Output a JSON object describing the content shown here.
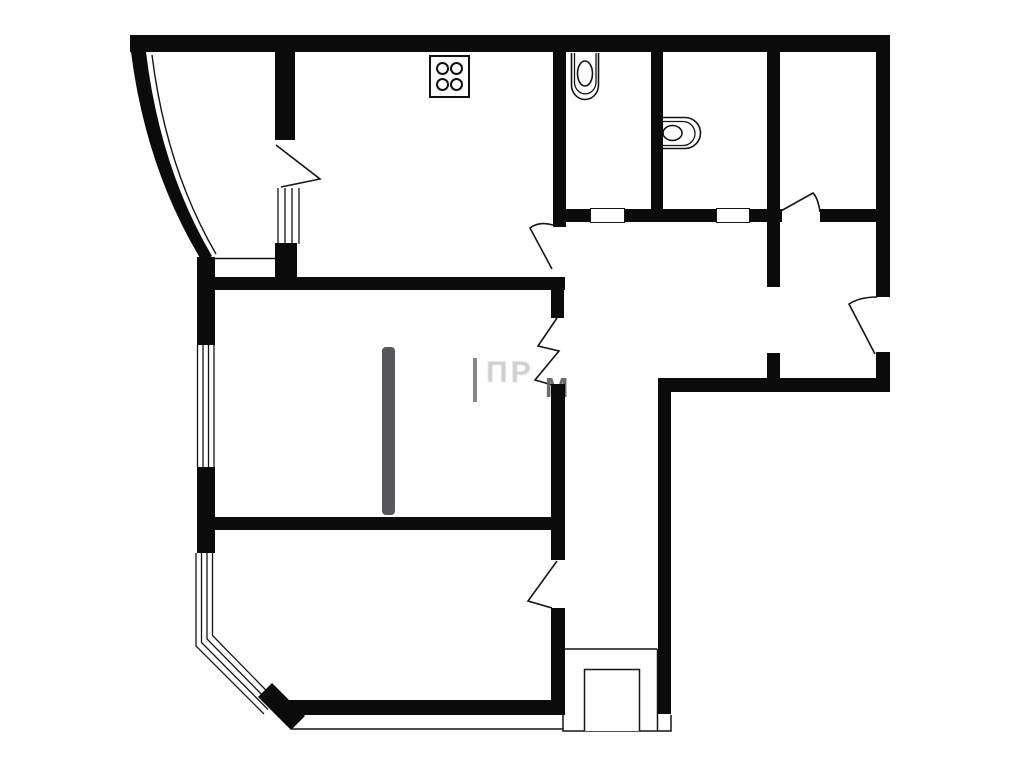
{
  "document": {
    "type": "apartment-floor-plan",
    "background": "#ffffff",
    "ink": "#0b0b0b"
  },
  "watermark": {
    "fragment_1": "ПР",
    "fragment_2": "М"
  },
  "plan": {
    "canvas": {
      "width": 1023,
      "height": 768
    },
    "walls": [
      {
        "name": "wall-top",
        "x": 130,
        "y": 35,
        "w": 760,
        "h": 17
      },
      {
        "name": "wall-right-upper",
        "x": 876,
        "y": 35,
        "w": 14,
        "h": 262
      },
      {
        "name": "wall-right-stub",
        "x": 876,
        "y": 352,
        "w": 14,
        "h": 40
      },
      {
        "name": "wall-closet-left",
        "x": 767,
        "y": 52,
        "w": 13,
        "h": 235
      },
      {
        "name": "wall-closet-left-stub",
        "x": 767,
        "y": 353,
        "w": 13,
        "h": 29
      },
      {
        "name": "wall-wc-bath-divider",
        "x": 651,
        "y": 52,
        "w": 12,
        "h": 161
      },
      {
        "name": "wall-wc-left",
        "x": 553,
        "y": 52,
        "w": 13,
        "h": 175
      },
      {
        "name": "wall-hall-south",
        "x": 658,
        "y": 378,
        "w": 232,
        "h": 14
      },
      {
        "name": "wall-right-lower",
        "x": 658,
        "y": 378,
        "w": 13,
        "h": 336
      },
      {
        "name": "wall-sanitary-south-a",
        "x": 566,
        "y": 209,
        "w": 24,
        "h": 13
      },
      {
        "name": "wall-sanitary-south-b",
        "x": 625,
        "y": 209,
        "w": 91,
        "h": 13
      },
      {
        "name": "wall-sanitary-south-c",
        "x": 750,
        "y": 209,
        "w": 32,
        "h": 13
      },
      {
        "name": "wall-sanitary-south-d",
        "x": 820,
        "y": 209,
        "w": 58,
        "h": 13
      },
      {
        "name": "wall-hall-west-a",
        "x": 551,
        "y": 285,
        "w": 13,
        "h": 33
      },
      {
        "name": "wall-hall-west-b",
        "x": 551,
        "y": 384,
        "w": 14,
        "h": 176
      },
      {
        "name": "wall-hall-west-c",
        "x": 551,
        "y": 608,
        "w": 14,
        "h": 107
      },
      {
        "name": "wall-mid-upper",
        "x": 198,
        "y": 277,
        "w": 367,
        "h": 13
      },
      {
        "name": "wall-mid-lower",
        "x": 198,
        "y": 517,
        "w": 367,
        "h": 13
      },
      {
        "name": "wall-left-a",
        "x": 197,
        "y": 257,
        "w": 18,
        "h": 88
      },
      {
        "name": "wall-left-b",
        "x": 197,
        "y": 467,
        "w": 18,
        "h": 86
      },
      {
        "name": "wall-partition-upper",
        "x": 275,
        "y": 52,
        "w": 20,
        "h": 88
      },
      {
        "name": "wall-partition-stub",
        "x": 275,
        "y": 243,
        "w": 22,
        "h": 47
      },
      {
        "name": "wall-bottom",
        "x": 288,
        "y": 700,
        "w": 277,
        "h": 15
      }
    ],
    "thresholds": [
      {
        "name": "wc-door-threshold",
        "x": 590,
        "y": 208,
        "w": 35,
        "h": 15
      },
      {
        "name": "bath-door-threshold",
        "x": 716,
        "y": 208,
        "w": 34,
        "h": 15
      }
    ],
    "furniture": [
      {
        "name": "wardrobe-strip",
        "x": 382,
        "y": 347,
        "w": 13,
        "h": 168,
        "color": "#57575b"
      }
    ],
    "stove": {
      "x": 429,
      "y": 55,
      "w": 41,
      "h": 43,
      "burners": 4
    },
    "svg": [
      {
        "name": "bay-curved-wall",
        "d": "M131,52 H146 Q160,168 212,256 L203,263 Q146,170 131,52 Z",
        "fill": "#0b0b0b",
        "sw": 0
      },
      {
        "name": "bay-glazing-line",
        "d": "M152,55 Q166,168 216,254",
        "sw": 1.4
      },
      {
        "name": "window-left-upper",
        "d": "M197.5,345 V467 M203,345 V467 M208.5,345 V467 M214,345 V467",
        "sw": 1.3
      },
      {
        "name": "window-partition",
        "d": "M278,188 V244 M285,188 V244 M292,188 V244 M299,188 V244",
        "sw": 1.3
      },
      {
        "name": "window-bay-lower",
        "d": "M196,553 V646 L264,714 M201.5,553 V642.5 L268,709.5 M207,553 V639 L272,705 M212.5,553 V635.5 L276,700.5",
        "sw": 1.3
      },
      {
        "name": "bay-corner-wall",
        "d": "M258,697 L272,683 L305,716 L291,730 Z",
        "fill": "#0b0b0b",
        "sw": 0
      },
      {
        "name": "threshold-line-left",
        "d": "M213,258.5 H277",
        "sw": 1.5
      },
      {
        "name": "outline-bottom-thin",
        "d": "M291,729 H563",
        "sw": 1.5
      },
      {
        "name": "entry-recess-outer",
        "d": "M563,714 V731 H671 V715 M564,649 H657.5 M657.5,649 V731",
        "sw": 1.5
      },
      {
        "name": "entry-recess-inner",
        "d": "M584.5,731 V669.5 H639.5 V731",
        "fill": "#ffffff",
        "sw": 1.5
      },
      {
        "name": "door-bay-room",
        "d": "M276,145 L320,179 L281,187",
        "sw": 1.6
      },
      {
        "name": "door-kitchen",
        "d": "M553,225 Q539,221 530,228 L552,269",
        "sw": 1.6
      },
      {
        "name": "door-living-room",
        "d": "M557,561 L528,601 L552,608",
        "sw": 1.6
      },
      {
        "name": "door-closet",
        "d": "M820,212 Q818,198 813,193 L779,212",
        "sw": 1.6
      },
      {
        "name": "door-entrance",
        "d": "M877,297 Q860,297 849,304 L875,354",
        "sw": 1.6
      },
      {
        "name": "opening-zigzag",
        "d": "M557,318 L538,346 L559,351 L535,380 L556,386",
        "sw": 1.6
      },
      {
        "name": "toilet-outer",
        "d": "M571.5,53 V85 A13.5,14.5 0 0 0 598.5,85 V53",
        "sw": 1.6
      },
      {
        "name": "toilet-inner",
        "d": "M574.5,53 V83 A10.8,12 0 0 0 596,83 V53",
        "sw": 1.3
      },
      {
        "name": "toilet-bowl",
        "ellipse": [
          585,
          73.5,
          7.5,
          12.5
        ],
        "sw": 1.6
      },
      {
        "name": "washbasin-outer",
        "d": "M657.5,117.5 H685 A15.5,15.5 0 0 1 685,148.5 H657.5 Z",
        "sw": 1.6
      },
      {
        "name": "washbasin-inner",
        "d": "M659.5,121.5 H683 A12,12 0 0 1 683,145.5 H659.5 Z",
        "sw": 1.3
      },
      {
        "name": "washbasin-oval",
        "ellipse": [
          672.5,
          133,
          9.5,
          7.5
        ],
        "sw": 1.6
      }
    ]
  }
}
